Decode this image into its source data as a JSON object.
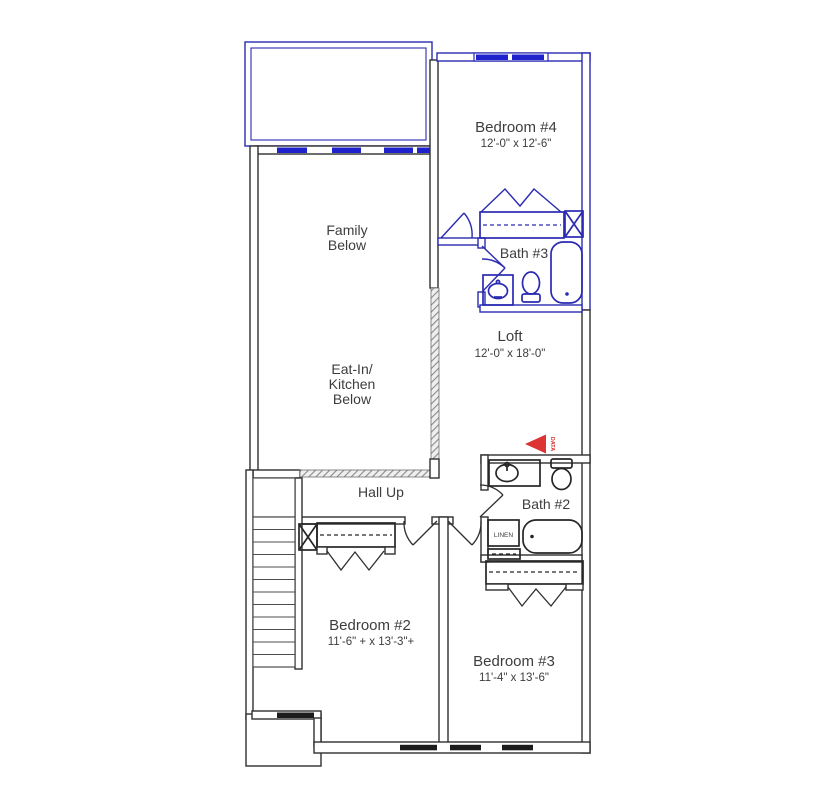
{
  "colors": {
    "new_construction_blue": "#2a2ab2",
    "window_glass_blue": "#1f22cc",
    "wall_black": "#2f2f2f",
    "railing_hatch_gray": "#8a8a8a",
    "data_marker_red": "#dd3333",
    "label_text": "#3d3d3d",
    "background": "#ffffff"
  },
  "rooms": {
    "bedroom4": {
      "name": "Bedroom #4",
      "dims": "12'-0\" x 12'-6\""
    },
    "family": {
      "line1": "Family",
      "line2": "Below"
    },
    "eat_in": {
      "line1": "Eat-In/",
      "line2": "Kitchen",
      "line3": "Below"
    },
    "bath3": {
      "name": "Bath #3"
    },
    "loft": {
      "name": "Loft",
      "dims": "12'-0\" x 18'-0\""
    },
    "hall": {
      "name": "Hall Up"
    },
    "bath2": {
      "name": "Bath #2"
    },
    "bedroom2": {
      "name": "Bedroom #2",
      "dims": "11'-6\" + x 13'-3\"+"
    },
    "bedroom3": {
      "name": "Bedroom #3",
      "dims": "11'-4\" x 13'-6\""
    }
  },
  "annotations": {
    "linen_closet": "LINEN",
    "data_outlet": "DATA"
  },
  "icons": [
    "bathtub-icon",
    "toilet-icon",
    "sink-icon",
    "closet-shelf-rod-icon",
    "bifold-door-icon",
    "double-closet-door-icon",
    "door-swing-icon",
    "stairs-icon",
    "window-icon",
    "railing-hatch-icon",
    "data-outlet-arrow-icon",
    "x-chase-icon"
  ]
}
